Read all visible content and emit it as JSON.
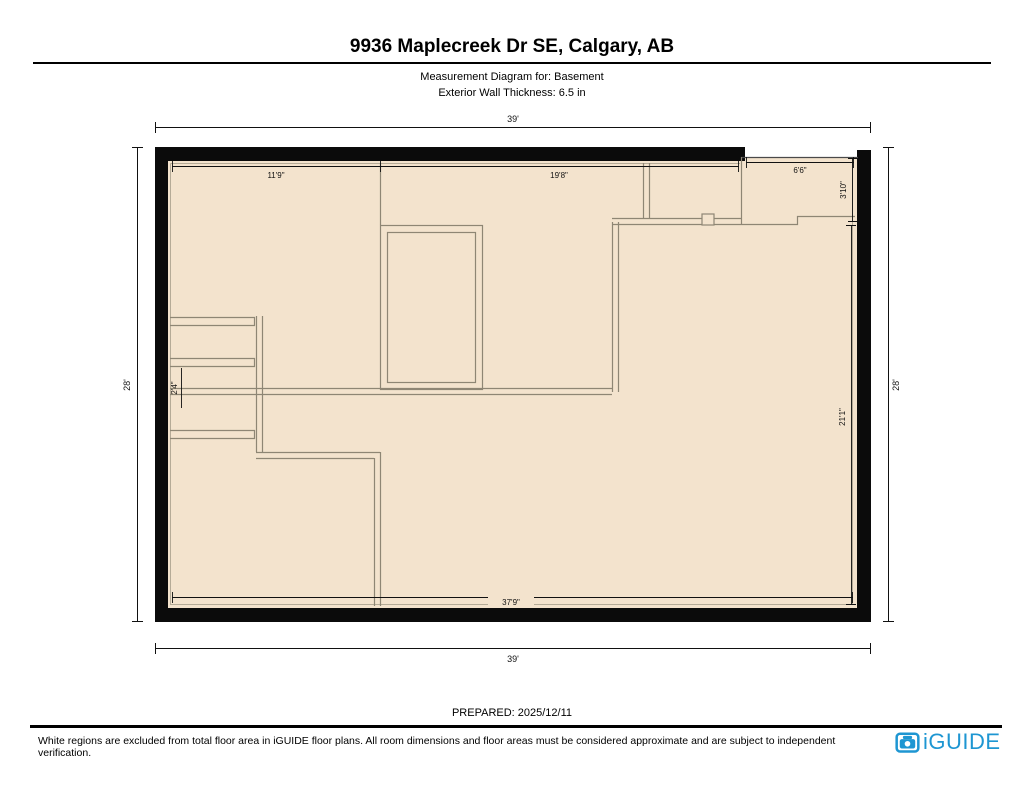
{
  "header": {
    "title": "9936 Maplecreek Dr SE, Calgary, AB",
    "subtitle1": "Measurement Diagram for: Basement",
    "subtitle2": "Exterior Wall Thickness: 6.5 in"
  },
  "floorplan": {
    "outer_dimensions": {
      "top": "39'",
      "bottom": "39'",
      "left": "28'",
      "right": "28'"
    },
    "interior_dimensions": {
      "top_left": "11'9\"",
      "top_middle": "19'8\"",
      "notch_width": "6'6\"",
      "notch_height": "3'10\"",
      "right": "21'1\"",
      "bottom": "37'9\"",
      "stair": "2'4\""
    },
    "colors": {
      "floor_fill": "#F3E3CD",
      "wall": "#0B0B0B",
      "interior_line": "#8E8674"
    }
  },
  "footer": {
    "prepared": "PREPARED: 2025/12/11",
    "disclaimer": "White regions are excluded from total floor area in iGUIDE floor plans. All room dimensions and floor areas must be considered approximate and are subject to independent verification.",
    "logo_text": "iGUIDE",
    "logo_color": "#1E96D2"
  }
}
